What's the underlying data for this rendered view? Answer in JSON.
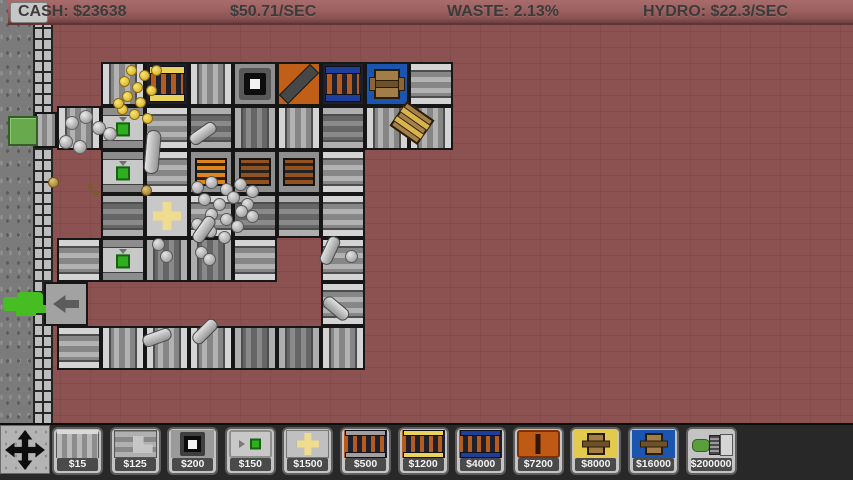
{
  "topbar": {
    "cash": "CASH: $23638",
    "income_rate": "$50.71/SEC",
    "waste": "WASTE: 2.13%",
    "hydro_rate": "HYDRO: $22.3/SEC"
  },
  "palette": {
    "topbar-bg": "#9c6060",
    "topbar-text": "#3b3b3b",
    "floor": "#8c5252",
    "ground": "#7b7b7b",
    "wall-brick": "#bdbdbd",
    "belt-light": "#b2b2b2",
    "belt-dark": "#666666",
    "accent-green": "#2fae1f",
    "furnace-orange": "#b45c1d",
    "cap-yellow": "#e9d35c",
    "cap-blue": "#1d3f9b",
    "machine-orange": "#c06018",
    "machine-blue": "#1c55b0",
    "crate-brown": "#a37d47",
    "coin-gold": "#ddb92f",
    "toolbar-bg": "#282828",
    "button-face": "#c4c4c4",
    "price-text": "#f2f2f2"
  },
  "toolbar": {
    "items": [
      {
        "name": "conveyor",
        "icon": "conv",
        "price": "$15"
      },
      {
        "name": "conveyor-corner",
        "icon": "corner",
        "price": "$125"
      },
      {
        "name": "wall-block",
        "icon": "block",
        "price": "$200"
      },
      {
        "name": "importer",
        "icon": "buyer",
        "price": "$150"
      },
      {
        "name": "press",
        "icon": "plus",
        "price": "$1500"
      },
      {
        "name": "furnace",
        "icon": "furn",
        "price": "$500"
      },
      {
        "name": "gold-furnace",
        "icon": "furnY",
        "price": "$1200"
      },
      {
        "name": "blue-furnace",
        "icon": "furnB",
        "price": "$4000"
      },
      {
        "name": "smelter",
        "icon": "slit",
        "price": "$7200"
      },
      {
        "name": "crate-packer",
        "icon": "crateY",
        "price": "$8000"
      },
      {
        "name": "blue-crate-packer",
        "icon": "crateB",
        "price": "$16000"
      },
      {
        "name": "hydro-generator",
        "icon": "hydro",
        "price": "$200000"
      }
    ]
  },
  "factory": {
    "tile_size": 44,
    "origin_x": 57,
    "origin_y": 62,
    "tiles": [
      [
        1,
        0,
        "ch"
      ],
      [
        2,
        0,
        "fy"
      ],
      [
        3,
        0,
        "ch"
      ],
      [
        4,
        0,
        "blk"
      ],
      [
        5,
        0,
        "cru"
      ],
      [
        6,
        0,
        "fb"
      ],
      [
        7,
        0,
        "crb"
      ],
      [
        8,
        0,
        "cv"
      ],
      [
        0,
        1,
        "ch"
      ],
      [
        1,
        1,
        "buy"
      ],
      [
        2,
        1,
        "cv"
      ],
      [
        3,
        1,
        "cvd"
      ],
      [
        4,
        1,
        "chd"
      ],
      [
        5,
        1,
        "ch"
      ],
      [
        6,
        1,
        "cvd"
      ],
      [
        7,
        1,
        "ch"
      ],
      [
        8,
        1,
        "ch"
      ],
      [
        1,
        2,
        "buy"
      ],
      [
        2,
        2,
        "cv"
      ],
      [
        3,
        2,
        "rkh"
      ],
      [
        4,
        2,
        "rkc"
      ],
      [
        5,
        2,
        "rkc"
      ],
      [
        6,
        2,
        "cv"
      ],
      [
        1,
        3,
        "cvd"
      ],
      [
        2,
        3,
        "plus"
      ],
      [
        3,
        3,
        "cv"
      ],
      [
        4,
        3,
        "cvd"
      ],
      [
        5,
        3,
        "cvd"
      ],
      [
        6,
        3,
        "cv"
      ],
      [
        0,
        4,
        "cv"
      ],
      [
        1,
        4,
        "buy"
      ],
      [
        2,
        4,
        "chd"
      ],
      [
        3,
        4,
        "chd"
      ],
      [
        4,
        4,
        "cv"
      ],
      [
        6,
        4,
        "cv"
      ],
      [
        0,
        5,
        "exit"
      ],
      [
        6,
        5,
        "cv"
      ],
      [
        0,
        6,
        "cv"
      ],
      [
        1,
        6,
        "ch"
      ],
      [
        2,
        6,
        "ch"
      ],
      [
        3,
        6,
        "ch"
      ],
      [
        4,
        6,
        "chd"
      ],
      [
        5,
        6,
        "chd"
      ],
      [
        6,
        6,
        "ch"
      ]
    ],
    "items": [
      [
        "stub",
        46,
        130
      ],
      [
        "coin",
        131,
        70
      ],
      [
        "coin",
        144,
        75
      ],
      [
        "coin",
        124,
        81
      ],
      [
        "coin",
        137,
        87
      ],
      [
        "coin",
        151,
        90
      ],
      [
        "coin",
        127,
        96
      ],
      [
        "coin",
        140,
        102
      ],
      [
        "coin",
        122,
        109
      ],
      [
        "coin",
        134,
        114
      ],
      [
        "coin",
        147,
        118
      ],
      [
        "coin",
        156,
        70
      ],
      [
        "coin",
        118,
        103
      ],
      [
        "stone",
        72,
        123
      ],
      [
        "stone",
        86,
        117
      ],
      [
        "stone",
        99,
        128
      ],
      [
        "stone",
        110,
        134
      ],
      [
        "stone",
        66,
        142
      ],
      [
        "stone",
        80,
        147
      ],
      [
        "barv",
        152,
        152,
        5
      ],
      [
        "ball",
        197,
        187
      ],
      [
        "ball",
        211,
        182
      ],
      [
        "ball",
        226,
        189
      ],
      [
        "ball",
        240,
        184
      ],
      [
        "ball",
        252,
        191
      ],
      [
        "ball",
        204,
        199
      ],
      [
        "ball",
        219,
        204
      ],
      [
        "ball",
        233,
        197
      ],
      [
        "ball",
        247,
        204
      ],
      [
        "ball",
        211,
        214
      ],
      [
        "ball",
        226,
        219
      ],
      [
        "ball",
        197,
        224
      ],
      [
        "ball",
        241,
        211
      ],
      [
        "ball",
        210,
        231
      ],
      [
        "ball",
        224,
        237
      ],
      [
        "ball",
        252,
        216
      ],
      [
        "ball",
        237,
        226
      ],
      [
        "ball",
        158,
        244
      ],
      [
        "ball",
        166,
        256
      ],
      [
        "ball",
        201,
        252
      ],
      [
        "ball",
        209,
        259
      ],
      [
        "ball",
        351,
        256
      ],
      [
        "gold",
        146,
        190
      ],
      [
        "gold",
        53,
        182
      ],
      [
        "waste",
        90,
        186
      ],
      [
        "waste",
        96,
        193
      ],
      [
        "bar",
        203,
        133,
        -35
      ],
      [
        "bar",
        204,
        229,
        -55
      ],
      [
        "bar",
        330,
        250,
        -65
      ],
      [
        "bar",
        336,
        308,
        40
      ],
      [
        "bar",
        157,
        337,
        -20
      ],
      [
        "bar",
        205,
        331,
        -45
      ],
      [
        "crate",
        412,
        123,
        35
      ]
    ]
  }
}
